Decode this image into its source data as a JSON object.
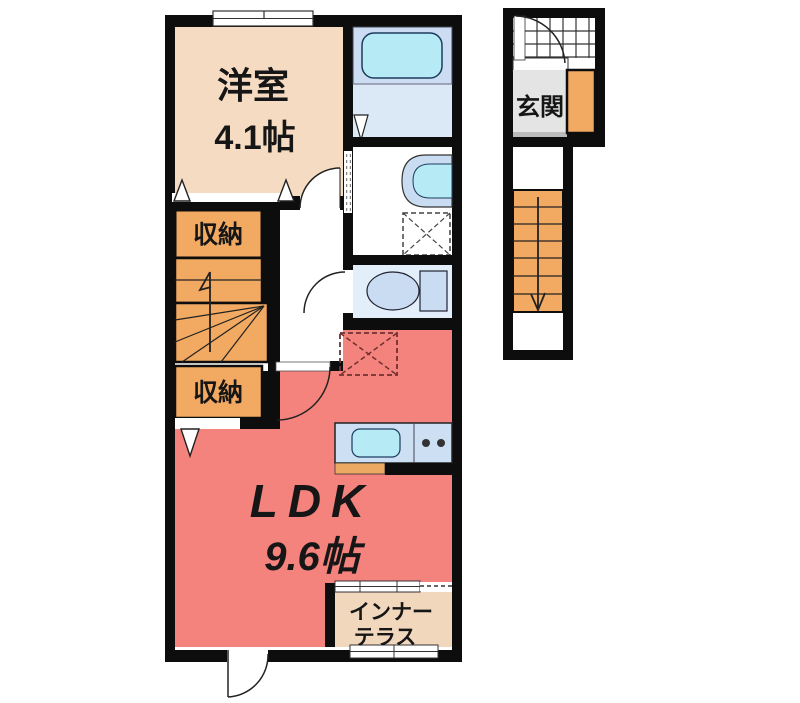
{
  "floor_plan": {
    "unit": {
      "western_room": {
        "label": "洋室",
        "size": "4.1帖"
      },
      "storage_upper": {
        "label": "収納"
      },
      "storage_lower": {
        "label": "収納"
      },
      "ldk": {
        "label": "LDK",
        "size": "9.6帖"
      },
      "inner_terrace": {
        "line1": "インナー",
        "line2": "テラス"
      }
    },
    "entrance_section": {
      "genkan": {
        "label": "玄関"
      }
    },
    "fixtures": [
      "bathtub",
      "bathroom-folding-door",
      "washbasin",
      "washing-machine-pan",
      "toilet",
      "kitchen-counter",
      "kitchen-sink",
      "stove-burners",
      "refrigerator-space",
      "interior-staircase",
      "entrance-staircase",
      "entrance-door",
      "window",
      "closet-doors"
    ],
    "colors": {
      "wall": "#0d0d0d",
      "western_room": "#f4dbc1",
      "storage": "#f2a961",
      "stairs": "#f2a961",
      "ldk": "#f5837d",
      "terrace": "#f1d7bc",
      "bath_zone": "#ccddf3",
      "bathtub": "#b6ebf6",
      "bath_floor": "#dbe9f7",
      "toilet_room": "#e2eef9",
      "fixture_fill": "#c9dcf2",
      "kitchen_counter": "#ccdff3",
      "sink": "#b6ebf6",
      "genkan_floor": "#e4e4e4",
      "counter_edge": "#eba963"
    }
  }
}
